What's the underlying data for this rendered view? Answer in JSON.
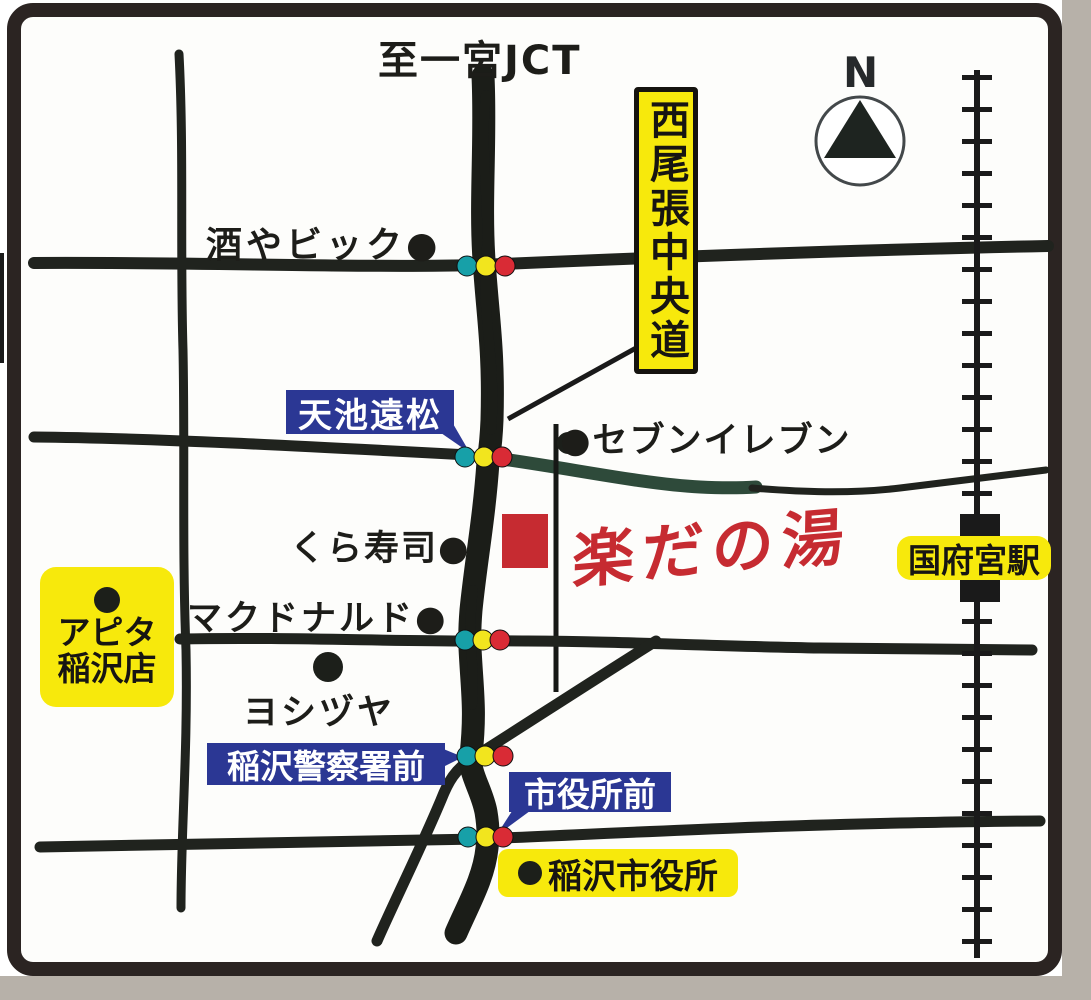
{
  "colors": {
    "road": "#20231e",
    "route_green": "#2e4a3a",
    "railway": "#1a1a1a",
    "signal_teal": "#17a0a8",
    "signal_yellow": "#f2e51e",
    "signal_red": "#d92b35",
    "label_yellow": "#f7e90c",
    "label_blue": "#2b3794",
    "brand_red": "#c62b31",
    "frame": "#2b2422",
    "scan_gray": "#b7b1a9",
    "poi_dot": "#1c1f1a"
  },
  "compass": {
    "label": "N"
  },
  "labels": {
    "top_destination": "至一宮JCT",
    "expressway": "西尾張中央道",
    "sake_bic": "酒やビック●",
    "amaike_tomatsu": "天池遠松",
    "seven_eleven": "●セブンイレブン",
    "kura_sushi": "くら寿司●",
    "mcdonalds": "マクドナルド●",
    "yoshizuya": "ヨシヅヤ",
    "apita_line1": "アピタ",
    "apita_line2": "稲沢店",
    "inazawa_police": "稲沢警察署前",
    "shiyakusho_mae": "市役所前",
    "inazawa_city_hall": "稲沢市役所",
    "konomiya_station": "国府宮駅",
    "logo": "楽だの湯"
  }
}
